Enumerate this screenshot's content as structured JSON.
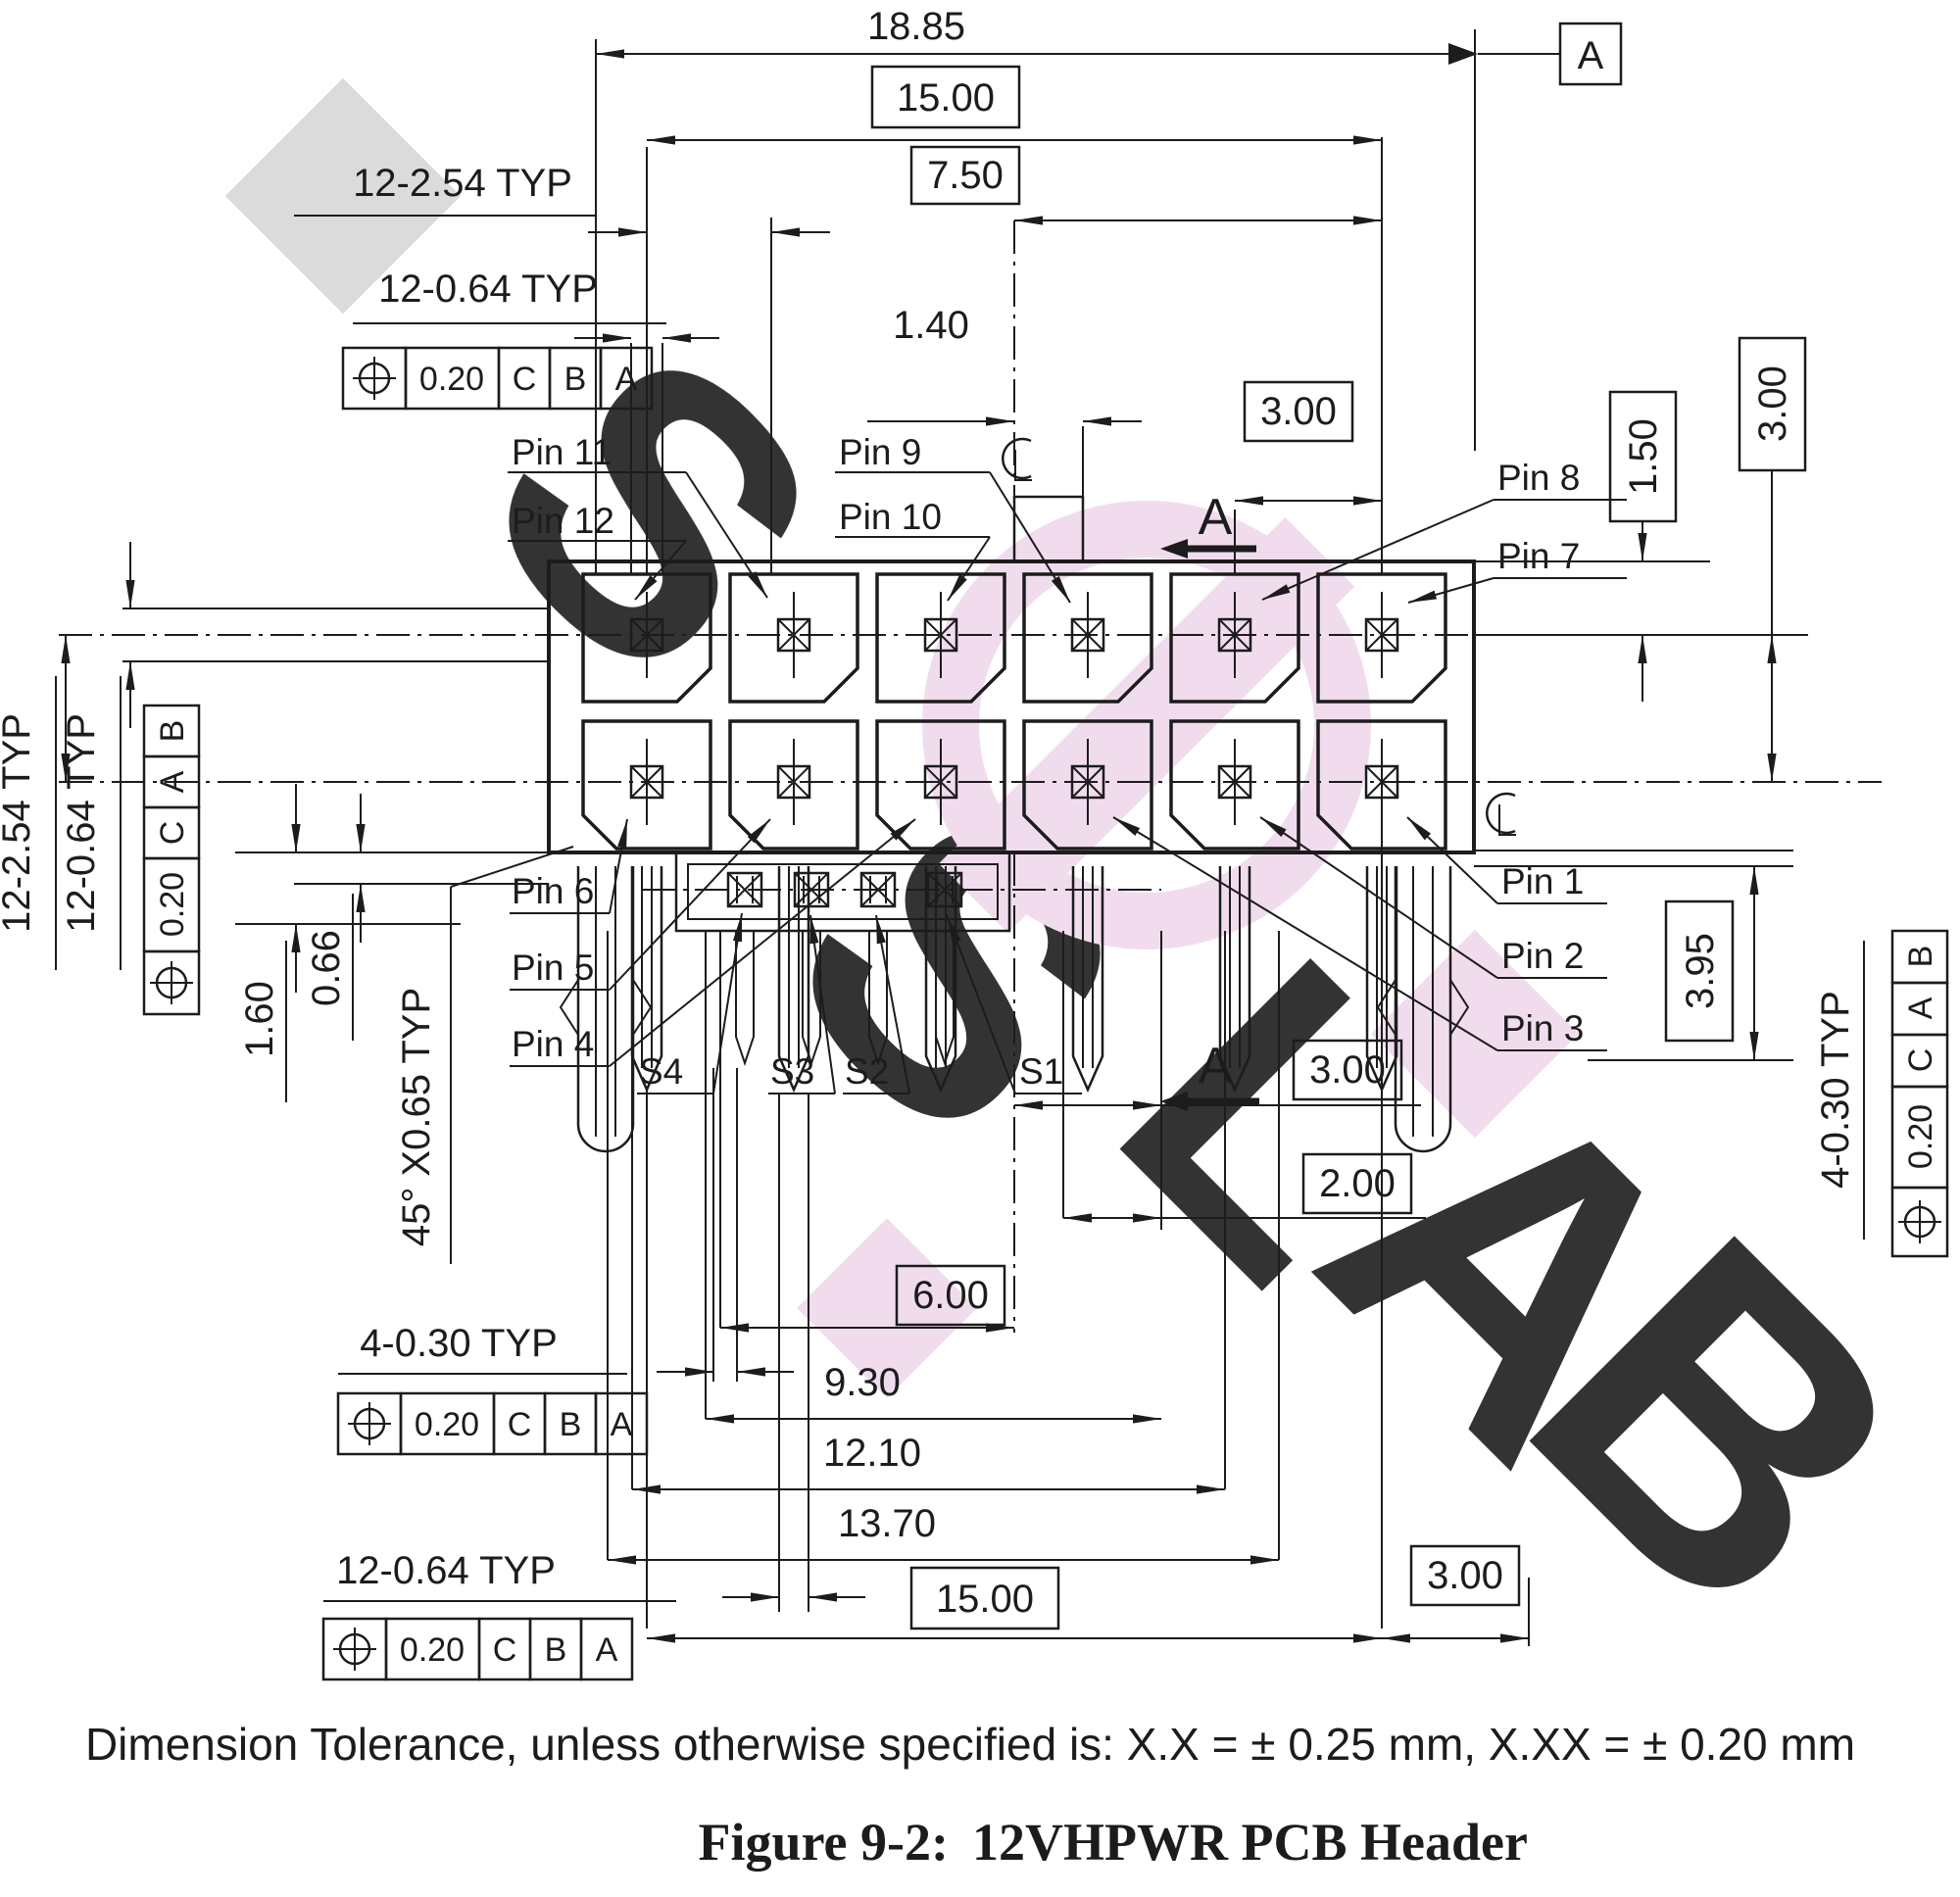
{
  "figure": {
    "label": "Figure 9-2:",
    "title": "12VHPWR PCB Header",
    "tolerance_note": "Dimension Tolerance, unless otherwise specified is:  X.X = ± 0.25 mm, X.XX = ± 0.20 mm"
  },
  "datum": {
    "flag": "A"
  },
  "sections": {
    "top": "A",
    "bottom": "A"
  },
  "dims": {
    "overall_width": "18.85",
    "pin_span_top": "15.00",
    "half_span": "7.50",
    "pitch_top": "3.00",
    "key_offset": "1.40",
    "pitch_typ_top": "12-2.54 TYP",
    "pin_w_typ_top": "12-0.64 TYP",
    "pitch_typ_left": "12-2.54 TYP",
    "pin_w_typ_left": "12-0.64 TYP",
    "edge_to_row": "1.50",
    "row_pitch_right": "3.00",
    "sideband_drop": "3.95",
    "hole_typ_right": "4-0.30 TYP",
    "standoff": "1.60",
    "lead_len": "0.66",
    "chamfer": "45° X0.65 TYP",
    "s1_to_center": "3.00",
    "s_pitch": "2.00",
    "s_span": "6.00",
    "d_930": "9.30",
    "d_1210": "12.10",
    "d_1370": "13.70",
    "pin_span_bottom": "15.00",
    "edge_right_bottom": "3.00",
    "hole_typ_bottom": "4-0.30 TYP",
    "pin_w_typ_bottom": "12-0.64 TYP"
  },
  "fcf": {
    "top": {
      "tol": "0.20",
      "d1": "C",
      "d2": "B",
      "d3": "A"
    },
    "left": {
      "tol": "0.20",
      "d1": "C",
      "d2": "A",
      "d3": "B"
    },
    "right": {
      "tol": "0.20",
      "d1": "C",
      "d2": "A",
      "d3": "B"
    },
    "bottom_hole": {
      "tol": "0.20",
      "d1": "C",
      "d2": "B",
      "d3": "A"
    },
    "bottom_pin": {
      "tol": "0.20",
      "d1": "C",
      "d2": "B",
      "d3": "A"
    }
  },
  "pins": {
    "p1": "Pin 1",
    "p2": "Pin 2",
    "p3": "Pin 3",
    "p4": "Pin 4",
    "p5": "Pin 5",
    "p6": "Pin 6",
    "p7": "Pin 7",
    "p8": "Pin 8",
    "p9": "Pin 9",
    "p10": "Pin 10",
    "p11": "Pin 11",
    "p12": "Pin 12"
  },
  "sideband": {
    "s1": "S1",
    "s2": "S2",
    "s3": "S3",
    "s4": "S4"
  },
  "watermark": {
    "pink": "#f0d9ec",
    "gray": "#d7d7d7",
    "letters": [
      "S",
      "S",
      "L",
      "A",
      "B"
    ]
  }
}
